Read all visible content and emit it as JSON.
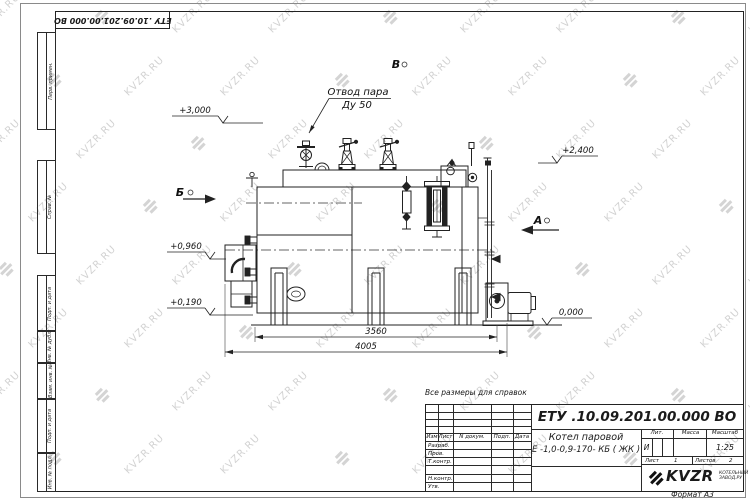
{
  "watermark": {
    "text": "KVZR.RU"
  },
  "stamp_top": {
    "doc_number": "ЕТУ .10.09.201.00.000  ВО"
  },
  "frame": {
    "side_labels": [
      "Перв. примен.",
      "Справ. №",
      "Подп. и дата",
      "Инв. № дубл.",
      "Взам. инв. №",
      "Подп. и дата",
      "Инв. № подл."
    ]
  },
  "note": "Все размеры для справок",
  "drawing": {
    "callout": {
      "line1": "Отвод пара",
      "line2": "Ду 50"
    },
    "elevation_marks": [
      "+3,000",
      "+2,400",
      "+0,960",
      "+0,190",
      "0,000"
    ],
    "dimensions": [
      "3560",
      "4005"
    ],
    "views": {
      "b": "Б",
      "v": "В",
      "a": "А"
    }
  },
  "title_block": {
    "doc_number": "ЕТУ .10.09.201.00.000  ВО",
    "product_name_line1": "Котел паровой",
    "product_name_line2": "Е -1,0-0,9-170- КБ ( ЖК )",
    "header_cols": {
      "izm": "Изм",
      "list": "Лист",
      "n_doc": "N докум.",
      "podp": "Подп.",
      "data": "Дата"
    },
    "staff_rows": [
      "Разраб.",
      "Пров.",
      "Т.контр.",
      "Н.контр.",
      "Утв."
    ],
    "lit_label": "Лит.",
    "massa_label": "Масса",
    "masshtab_label": "Масштаб",
    "lit_value": "И",
    "scale_value": "1:25",
    "sheet_label": "Лист",
    "sheet_value": "1",
    "sheets_label": "Листов",
    "sheets_value": "2",
    "company_logo_text": "KVZR",
    "company_sub_line1": "КОТЕЛЬНЫЙ",
    "company_sub_line2": "ЗАВОД.РУ",
    "format_label": "Формат А3"
  }
}
